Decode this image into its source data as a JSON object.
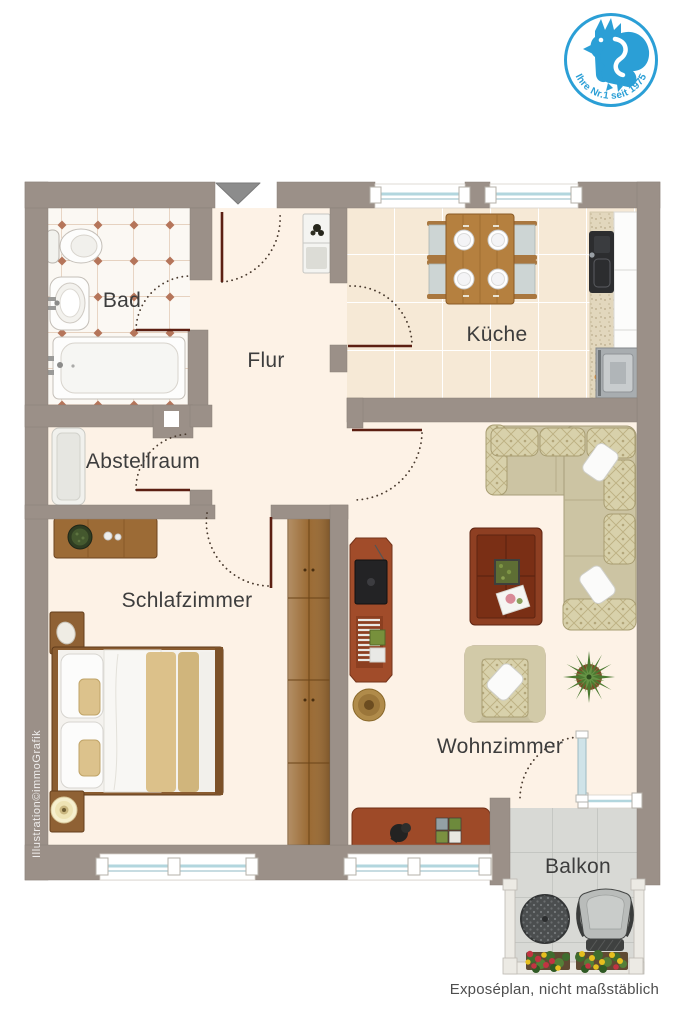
{
  "page": {
    "background": "#ffffff"
  },
  "logo": {
    "tagline": "Ihre Nr.1 seit 1975",
    "icon": "rooster-icon"
  },
  "footer": {
    "note": "Exposéplan, nicht maßstäblich"
  },
  "plan": {
    "entrance_side": "top",
    "watermark": "Illustration©immoGrafik",
    "rooms": {
      "bad": {
        "label": "Bad",
        "furniture": [
          "toilet",
          "washbasin",
          "bathtub"
        ]
      },
      "flur": {
        "label": "Flur",
        "furniture": [
          "hall-cabinet"
        ]
      },
      "kueche": {
        "label": "Küche",
        "furniture": [
          "dining-table",
          "dining-chairs",
          "plates",
          "kitchen-counter",
          "kitchen-sink",
          "fruit-bowl",
          "stove"
        ]
      },
      "abstellraum": {
        "label": "Abstellraum",
        "furniture": [
          "storage-cabinet"
        ]
      },
      "schlafzimmer": {
        "label": "Schlafzimmer",
        "furniture": [
          "dresser",
          "nightstand",
          "double-bed",
          "nightstand-with-lamp",
          "wardrobe"
        ]
      },
      "wohnzimmer": {
        "label": "Wohnzimmer",
        "furniture": [
          "tv-lowboard",
          "pouf",
          "corner-sofa",
          "coffee-table",
          "armchair",
          "plant",
          "sideboard"
        ]
      },
      "balkon": {
        "label": "Balkon",
        "furniture": [
          "bistro-table",
          "balcony-chair",
          "flower-boxes"
        ]
      }
    }
  },
  "colors": {
    "wall": "#9b9088",
    "floor": "#fdf2e6",
    "kitchen_floor": "#f6e9d6",
    "bath_floor": "#fbf8f3",
    "bath_grid": "#d2ab8c",
    "bath_diamond": "#b5755a",
    "balcony_floor": "#d8d9d5",
    "door_leaf": "#5c1f12",
    "window_glass": "#b2d6de",
    "wood": "#a9743d",
    "logo_blue": "#2b9fd6",
    "label_text": "#3d3d3d"
  }
}
